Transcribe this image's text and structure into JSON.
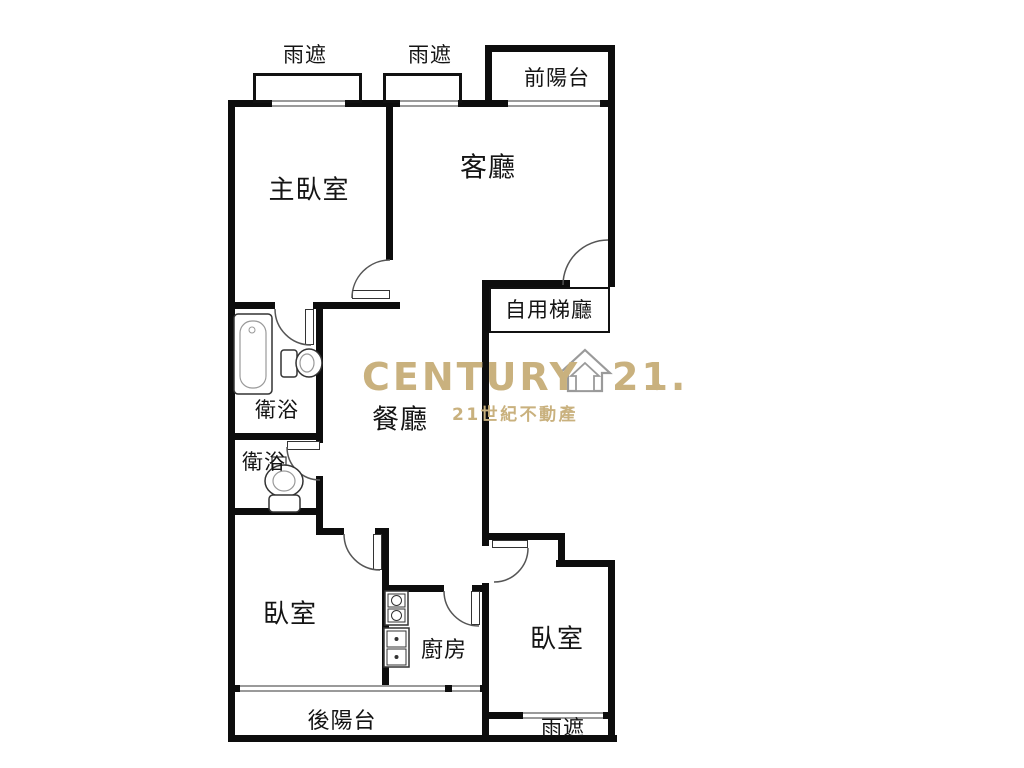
{
  "plan": {
    "labels": {
      "rain_cover_left": "雨遮",
      "rain_cover_mid": "雨遮",
      "front_balcony": "前陽台",
      "master_bedroom": "主臥室",
      "living_room": "客廳",
      "elevator_hall": "自用梯廳",
      "dining_room": "餐廳",
      "bathroom_upper": "衛浴",
      "bathroom_lower": "衛浴",
      "bedroom_left": "臥室",
      "bedroom_right": "臥室",
      "kitchen": "廚房",
      "rear_balcony": "後陽台",
      "rain_cover_bottom": "雨遮"
    },
    "watermark": {
      "brand": "CENTURY",
      "number": "21.",
      "registered": "®",
      "subtitle": "21世紀不動產",
      "gold_color": "#C9B17E"
    },
    "fixtures": [
      "bathtub-icon",
      "toilet-icon-upper",
      "toilet-icon-lower",
      "stove-icon",
      "sink-icon",
      "house-logo-icon"
    ],
    "wall_color": "#0d0d0d",
    "window_color": "#9a9a9a"
  }
}
